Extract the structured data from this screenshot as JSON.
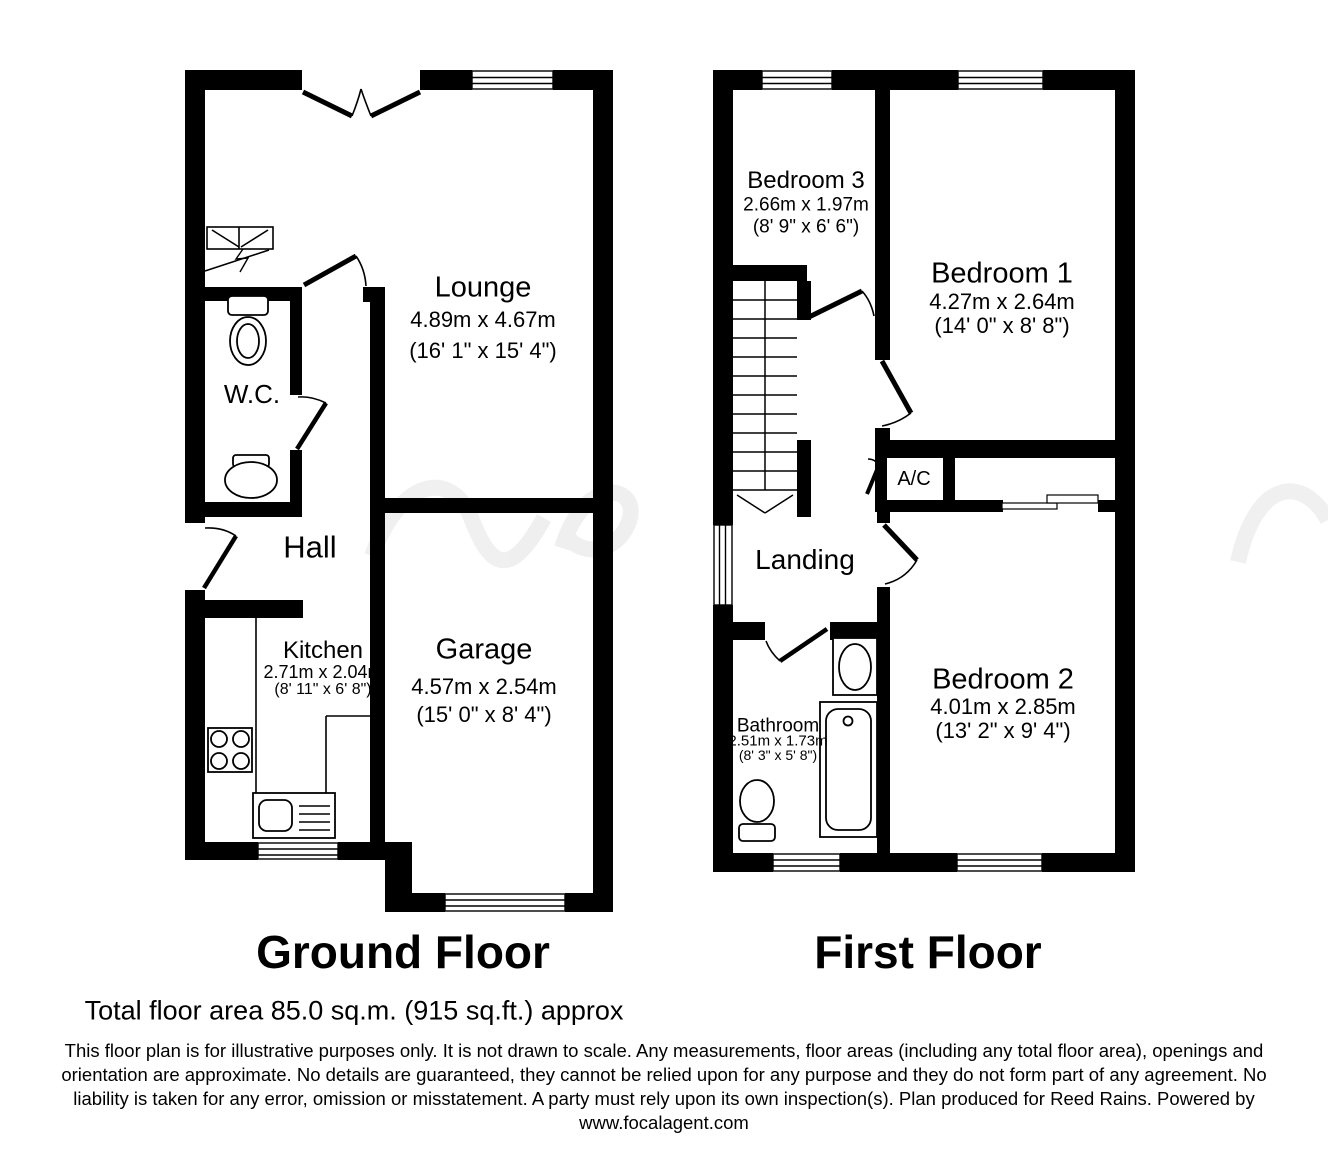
{
  "colors": {
    "wall": "#000000",
    "background": "#ffffff"
  },
  "ground_floor": {
    "title": "Ground Floor",
    "rooms": {
      "lounge": {
        "name": "Lounge",
        "metric": "4.89m x 4.67m",
        "imperial": "(16' 1\" x 15' 4\")"
      },
      "wc": {
        "name": "W.C."
      },
      "hall": {
        "name": "Hall"
      },
      "kitchen": {
        "name": "Kitchen",
        "metric": "2.71m x 2.04m",
        "imperial": "(8' 11\" x 6' 8\")"
      },
      "garage": {
        "name": "Garage",
        "metric": "4.57m x 2.54m",
        "imperial": "(15' 0\" x 8' 4\")"
      }
    }
  },
  "first_floor": {
    "title": "First Floor",
    "rooms": {
      "bedroom1": {
        "name": "Bedroom 1",
        "metric": "4.27m x 2.64m",
        "imperial": "(14' 0\" x 8' 8\")"
      },
      "bedroom2": {
        "name": "Bedroom 2",
        "metric": "4.01m x 2.85m",
        "imperial": "(13' 2\" x 9' 4\")"
      },
      "bedroom3": {
        "name": "Bedroom 3",
        "metric": "2.66m x 1.97m",
        "imperial": "(8' 9\" x 6' 6\")"
      },
      "bathroom": {
        "name": "Bathroom",
        "metric": "2.51m x 1.73m",
        "imperial": "(8' 3\" x 5' 8\")"
      },
      "landing": {
        "name": "Landing"
      },
      "ac": {
        "name": "A/C"
      }
    }
  },
  "footer": {
    "total_area": "Total floor area 85.0 sq.m. (915 sq.ft.) approx",
    "disclaimer_lines": [
      "This floor plan is for illustrative purposes only. It is not drawn to scale. Any measurements, floor areas (including any total floor area), openings and",
      "orientation are approximate. No details are guaranteed, they cannot be relied upon for any purpose and they do not form part of any agreement. No",
      "liability is taken for any error, omission or misstatement. A party must rely upon its own inspection(s). Plan produced for Reed Rains. Powered by"
    ],
    "website": "www.focalagent.com"
  }
}
